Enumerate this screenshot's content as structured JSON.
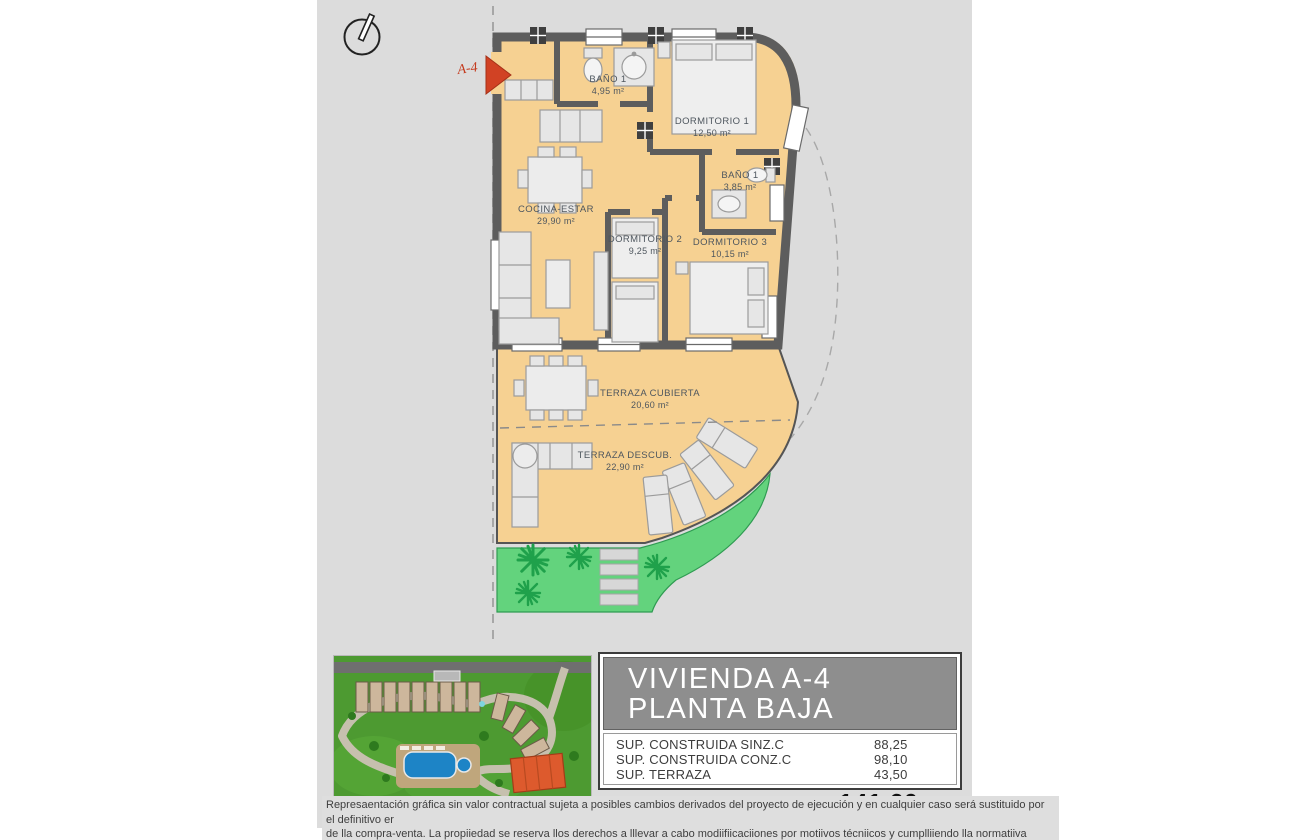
{
  "plan": {
    "marker_label": "A-4",
    "rooms": [
      {
        "name": "BAÑO 1",
        "area": "4,95 m²"
      },
      {
        "name": "DORMITORIO 1",
        "area": "12,50 m²"
      },
      {
        "name": "BAÑO 1",
        "area": "3,85 m²"
      },
      {
        "name": "COCINA-ESTAR",
        "area": "29,90 m²"
      },
      {
        "name": "DORMITORIO 2",
        "area": "9,25 m²"
      },
      {
        "name": "DORMITORIO 3",
        "area": "10,15 m²"
      },
      {
        "name": "TERRAZA CUBIERTA",
        "area": "20,60 m²"
      },
      {
        "name": "TERRAZA DESCUB.",
        "area": "22,90 m²"
      }
    ],
    "colors": {
      "floor": "#f6d192",
      "wall": "#5d5d5d",
      "garden": "#63d37d",
      "plant": "#1fa14b",
      "marker_red": "#d14224",
      "header_gray": "#8e8e8e"
    }
  },
  "info_panel": {
    "title_line1": "VIVIENDA A-4",
    "title_line2": "PLANTA BAJA",
    "rows": [
      {
        "label": "SUP. CONSTRUIDA SINZ.C",
        "value": "88,25"
      },
      {
        "label": "SUP. CONSTRUIDA CONZ.C",
        "value": "98,10"
      },
      {
        "label": "SUP. TERRAZA",
        "value": "43,50"
      }
    ],
    "total_label": "TOTAL SUPERFICE",
    "total_value": "141,60 m",
    "total_sup": "2"
  },
  "disclaimer": {
    "line1": "Represaentación gráfica sin valor contractual sujeta a posibles cambios derivados del proyecto de ejecución y en cualquier caso será sustituido por el definitivo er",
    "line2": "de lla compra-venta. La propiiedad se reserva llos derechos a lllevar a cabo modiifiicaciiones por motiivos técniicos y cumplliiendo lla normatiiva viigente."
  }
}
